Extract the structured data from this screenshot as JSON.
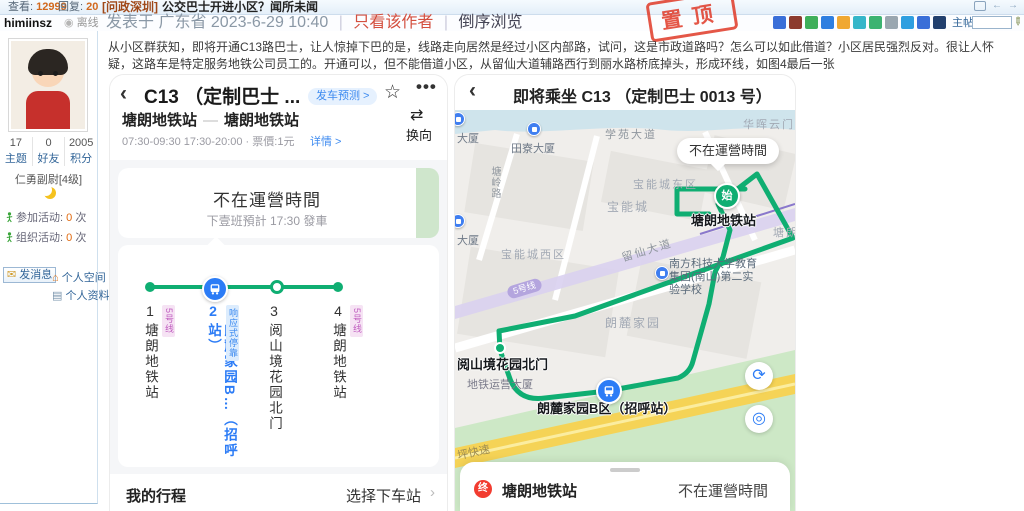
{
  "forum": {
    "topbar": {
      "views_label": "查看:",
      "views": "12999",
      "replies_label": "回复:",
      "replies": "20",
      "title_tag": "[问政深圳]",
      "title": "公交巴士开进小区？闻所未闻",
      "pin_stamp": "置顶"
    },
    "meta": {
      "username": "himiinsz",
      "status": "离线",
      "posted": "发表于 广东省 2023-6-29 10:40",
      "only_author": "只看该作者",
      "reverse_browse": "倒序浏览",
      "share_label": "主帖"
    },
    "sidebar": {
      "stats": [
        {
          "value": "17",
          "label": "主题"
        },
        {
          "value": "0",
          "label": "好友"
        },
        {
          "value": "2005",
          "label": "积分"
        }
      ],
      "rank": "仁勇副尉[4级]",
      "activities": [
        {
          "label": "参加活动:",
          "count": "0",
          "unit": "次"
        },
        {
          "label": "组织活动:",
          "count": "0",
          "unit": "次"
        }
      ],
      "send_message": "发消息",
      "personal_space": "个人空间",
      "profile": "个人资料"
    },
    "post_text": "从小区群获知，即将开通C13路巴士，让人惊掉下巴的是，线路走向居然是经过小区内部路，试问，这是市政道路吗？怎么可以如此借道？小区居民强烈反对。很让人怀疑，这路车是特定服务地铁公司员工的。开通可以，但不能借道小区，从留仙大道辅路西行到丽水路桥底掉头，形成环线，如图4最后一张"
  },
  "left_app": {
    "title": "C13 （定制巴士 ...",
    "predict_badge": "发车预测 >",
    "from": "塘朗地铁站",
    "to": "塘朗地铁站",
    "times": "07:30-09:30 17:30-20:00 · 票價:1元",
    "detail_link": "详情 >",
    "reverse_label": "换向",
    "status_title": "不在運營時間",
    "status_sub": "下壹班預計 17:30 發車",
    "stops": [
      {
        "num": "1",
        "name": "塘朗地铁站",
        "badge": "5号线"
      },
      {
        "num": "2",
        "name": "朗麓家园B…（招呼站）",
        "badge": "响应式停靠"
      },
      {
        "num": "3",
        "name": "阅山境花园北门",
        "badge": ""
      },
      {
        "num": "4",
        "name": "塘朗地铁站",
        "badge": "5号线"
      }
    ],
    "footer_left": "我的行程",
    "footer_right": "选择下车站"
  },
  "right_app": {
    "title": "即将乘坐 C13 （定制巴士 0013 号）",
    "map_bubble": "不在運營時間",
    "start_marker": "始",
    "metro_badge": "5号线",
    "map_labels": [
      {
        "text": "华晖云门"
      },
      {
        "text": "学苑大道"
      },
      {
        "text": "田寮大厦"
      },
      {
        "text": "塘岭路"
      },
      {
        "text": "宝能城东区"
      },
      {
        "text": "宝能城"
      },
      {
        "text": "宝能城西区"
      },
      {
        "text": "留仙大道"
      },
      {
        "text": "南方科技大学教育集团(南山)第二实验学校"
      },
      {
        "text": "朗麓家园"
      },
      {
        "text": "阅山境花园北门"
      },
      {
        "text": "地铁运营大厦"
      },
      {
        "text": "朗麓家园B区（招呼站）"
      },
      {
        "text": "坪快速"
      },
      {
        "text": "塘朗地铁站"
      },
      {
        "text": "大厦"
      },
      {
        "text": "大厦"
      },
      {
        "text": "塘朗"
      }
    ],
    "sheet": {
      "end_marker": "终",
      "station": "塘朗地铁站",
      "status": "不在運營時間"
    }
  }
}
